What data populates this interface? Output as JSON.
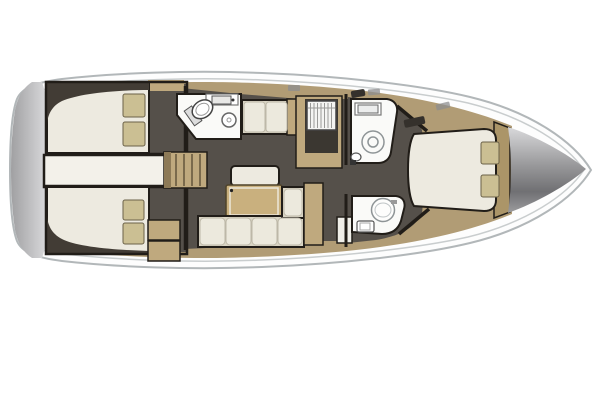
{
  "meta": {
    "title": "Sailing yacht interior layout — top-down floor plan",
    "view": "overhead",
    "bow_direction": "right",
    "canvas": {
      "width": 600,
      "height": 400
    }
  },
  "colors": {
    "background": "#ffffff",
    "hull-fill": "#fdfdfd",
    "hull-stroke": "#b2b7b9",
    "hull-inner-stroke": "#c9cdce",
    "deck": "#b19c75",
    "wood": "#bfa97e",
    "wood-dark": "#ab9568",
    "floor": "#55504a",
    "floor-dark": "#3b3731",
    "wedge": "#423c35",
    "berth": "#edeae0",
    "berth-bright": "#f3f1ea",
    "cushion": "#ece9dd",
    "cushion-base": "#d9d4c4",
    "pillow": "#cbbf93",
    "bathroom": "#fafaf8",
    "outline": "#211d18",
    "fixture-stroke": "#8e9496",
    "metal-light": "#d9d9db",
    "metal-dark": "#707073",
    "stern-light": "#e6e6e8",
    "stern-dark": "#a0a0a2",
    "table": "#c9b07e",
    "hatch": "#35312c",
    "step-line": "#7a6a4c"
  },
  "layout": {
    "rooms": [
      {
        "id": "aft-cabin-top",
        "type": "double-berth-cabin",
        "features": [
          "double-berth",
          "two-pillows",
          "hull-wedge",
          "floor"
        ]
      },
      {
        "id": "aft-cabin-bottom",
        "type": "double-berth-cabin",
        "features": [
          "double-berth",
          "two-pillows",
          "hull-wedge",
          "floor",
          "cabinets"
        ]
      },
      {
        "id": "engine-compartment",
        "type": "center-compartment"
      },
      {
        "id": "companionway-stairs",
        "type": "stairs",
        "steps": 4
      },
      {
        "id": "aft-head",
        "type": "bathroom",
        "features": [
          "toilet",
          "washbasin",
          "counter-sink"
        ]
      },
      {
        "id": "saloon",
        "type": "salon",
        "features": [
          "l-shaped-sofa",
          "table",
          "chaise-seat",
          "settee",
          "side-cabinet"
        ]
      },
      {
        "id": "galley",
        "type": "galley",
        "features": [
          "stove-grid",
          "counters"
        ]
      },
      {
        "id": "forward-head-top",
        "type": "bathroom",
        "features": [
          "counter-sink",
          "shower",
          "toilet"
        ]
      },
      {
        "id": "forward-head-bottom",
        "type": "bathroom",
        "features": [
          "round-basin",
          "toilet"
        ]
      },
      {
        "id": "forward-cabin",
        "type": "island-berth-cabin",
        "features": [
          "island-double-berth",
          "two-pillows",
          "headboard"
        ]
      },
      {
        "id": "bow-locker",
        "type": "anchor-locker"
      },
      {
        "id": "transom",
        "type": "stern-platform"
      }
    ]
  }
}
